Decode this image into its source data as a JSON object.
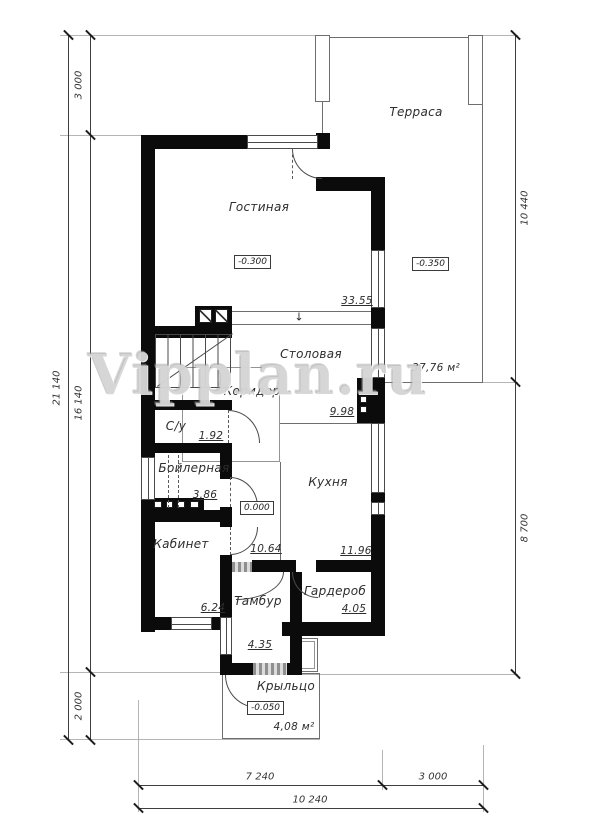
{
  "watermark": "Vipplan.ru",
  "icons": {
    "step_arrow": "↓"
  },
  "rooms": {
    "terrace": {
      "label": "Терраса",
      "area": "37,76 м²",
      "elevation": "-0.350"
    },
    "living": {
      "label": "Гостиная",
      "area": "33.55",
      "elevation": "-0.300"
    },
    "dining": {
      "label": "Столовая"
    },
    "corridor": {
      "label": "Коридор",
      "area": "9.98"
    },
    "wc": {
      "label": "С/у",
      "area": "1.92"
    },
    "boiler": {
      "label": "Бойлерная",
      "area": "3.86"
    },
    "office": {
      "label": "Кабинет",
      "area": "6.24"
    },
    "hall": {
      "area": "10.64",
      "elevation": "0.000"
    },
    "kitchen": {
      "label": "Кухня",
      "area": "11.96"
    },
    "wardrobe": {
      "label": "Гардероб",
      "area": "4.05"
    },
    "tambour": {
      "label": "Тамбур",
      "area": "4.35"
    },
    "porch": {
      "label": "Крыльцо",
      "area": "4,08 м²",
      "elevation": "-0.050"
    }
  },
  "dimensions": {
    "left_outer": "21 140",
    "left_top": "3 000",
    "left_middle": "16 140",
    "left_bottom": "2 000",
    "right_top": "10 440",
    "right_bottom": "8 700",
    "bottom_left": "7 240",
    "bottom_right": "3 000",
    "bottom_total": "10 240"
  },
  "colors": {
    "wall": "#0b0b0b",
    "thin_line": "#6e6e6e",
    "dimension": "#3f3f3f",
    "watermark": "#b2b2b2"
  }
}
